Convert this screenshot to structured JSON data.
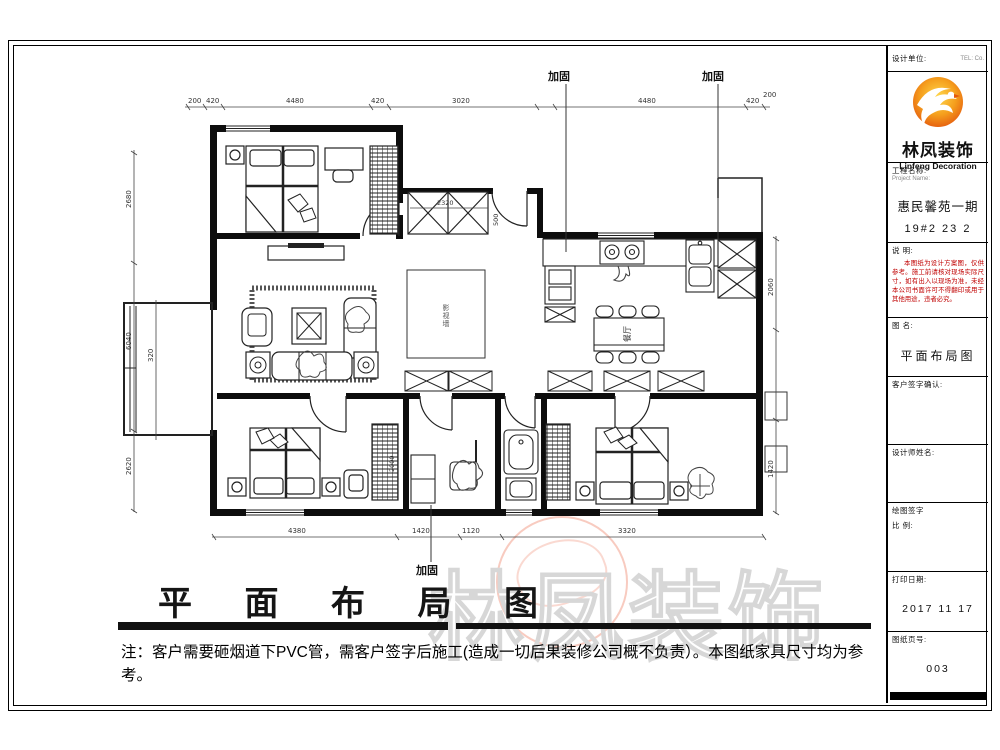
{
  "titleblock": {
    "designer_unit_label": "设计单位:",
    "tel_label": "TEL: Co.",
    "logo": {
      "cn": "林凤装饰",
      "en": "Linfeng Decoration"
    },
    "project_label": "工程名称:",
    "project_sublabel": "Project Name:",
    "project_name": "惠民馨苑一期",
    "project_no": "19#2 23 2",
    "remark_label": "说 明:",
    "remark_text": "本图纸为设计方案图，仅供参考。施工前请核对现场实际尺寸，如有出入以现场为准，未经本公司书面许可不得翻印或用于其他用途，违者必究。",
    "drawing_name_label": "图 名:",
    "drawing_name": "平面布局图",
    "client_sign_label": "客户签字确认:",
    "designer_label": "设计师姓名:",
    "draw_sign_label": "绘图签字",
    "scale_label": "比 例:",
    "print_date_label": "打印日期:",
    "print_date": "2017 11 17",
    "page_label": "图纸页号:",
    "page_no": "003"
  },
  "footer": {
    "title": "平 面 布 局 图",
    "note": "注：客户需要砸烟道下PVC管，需客户签字后施工(造成一切后果装修公司概不负责）。本图纸家具尺寸均为参考。"
  },
  "watermark": {
    "text": "林凤装饰"
  },
  "plan": {
    "callouts": {
      "top1": "加固",
      "top2": "加固",
      "bottom": "加固"
    },
    "labels": {
      "dining": "餐厅",
      "hall_area": "影视墙"
    },
    "dims": {
      "top": [
        "200",
        "420",
        "4480",
        "420",
        "3020",
        "4480",
        "420",
        "200"
      ],
      "bottom": [
        "4380",
        "1420",
        "1120",
        "3320"
      ],
      "left": [
        "2680",
        "6040",
        "2620"
      ],
      "left_inner": [
        "320"
      ],
      "right": [
        "2060",
        "1420"
      ],
      "inner": [
        "2320",
        "500",
        "2000"
      ]
    }
  }
}
